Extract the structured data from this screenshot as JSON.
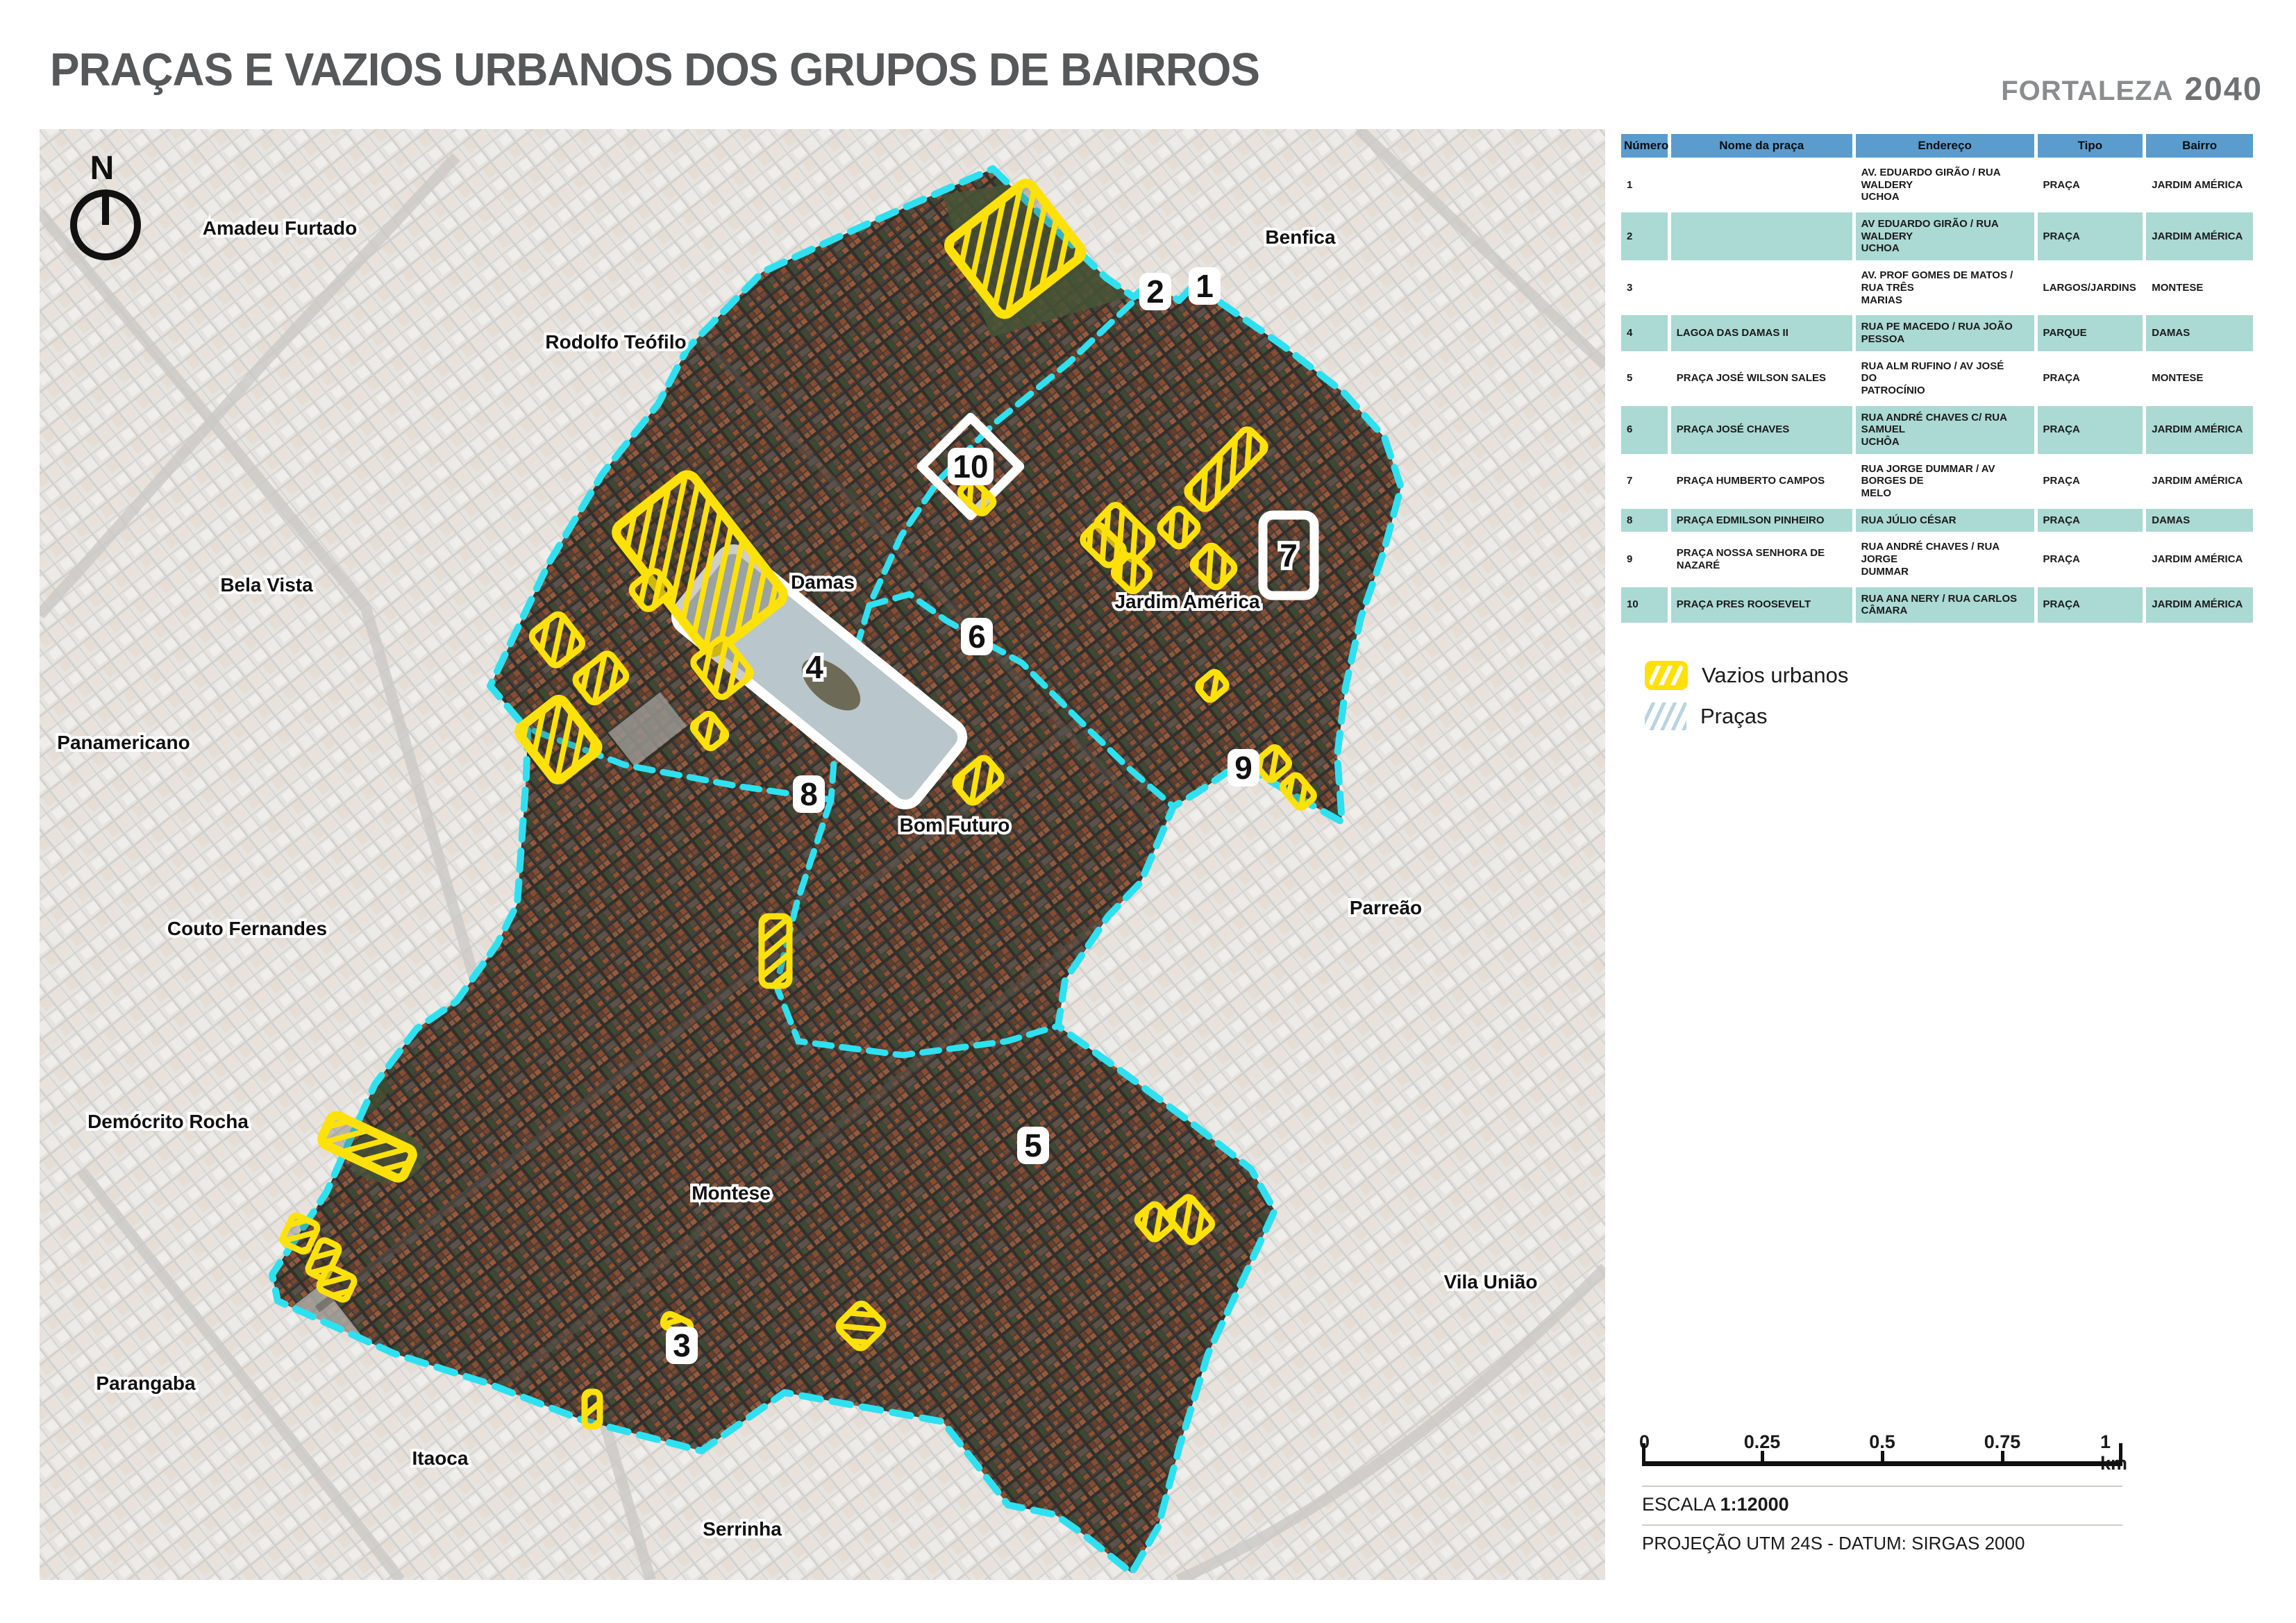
{
  "header": {
    "title": "PRAÇAS E VAZIOS URBANOS DOS GRUPOS DE BAIRROS",
    "brand_name": "FORTALEZA",
    "brand_year": "2040"
  },
  "map": {
    "compass": "N",
    "labels": [
      {
        "text": "Amadeu Furtado"
      },
      {
        "text": "Benfica"
      },
      {
        "text": "Rodolfo Teófilo"
      },
      {
        "text": "Bela Vista"
      },
      {
        "text": "Damas"
      },
      {
        "text": "Jardim América"
      },
      {
        "text": "Panamericano"
      },
      {
        "text": "Bom Futuro"
      },
      {
        "text": "Couto Fernandes"
      },
      {
        "text": "Parreão"
      },
      {
        "text": "Demócrito Rocha"
      },
      {
        "text": "Montese"
      },
      {
        "text": "Vila União"
      },
      {
        "text": "Parangaba"
      },
      {
        "text": "Itaoca"
      },
      {
        "text": "Serrinha"
      }
    ],
    "markers": [
      "1",
      "2",
      "3",
      "4",
      "5",
      "6",
      "7",
      "8",
      "9",
      "10"
    ]
  },
  "legend": {
    "items": [
      {
        "label": "Vazios urbanos",
        "swatch": "yellow-hatch"
      },
      {
        "label": "Praças",
        "swatch": "blue-hatch"
      }
    ]
  },
  "table": {
    "columns": [
      "Número",
      "Nome da praça",
      "Endereço",
      "Tipo",
      "Bairro"
    ],
    "rows": [
      {
        "numero": "1",
        "nome": "",
        "endereco": "AV. EDUARDO GIRÃO / RUA\nWALDERY\nUCHOA",
        "tipo": "PRAÇA",
        "bairro": "JARDIM AMÉRICA"
      },
      {
        "numero": "2",
        "nome": "",
        "endereco": "AV EDUARDO GIRÃO / RUA\nWALDERY\nUCHOA",
        "tipo": "PRAÇA",
        "bairro": "JARDIM AMÉRICA"
      },
      {
        "numero": "3",
        "nome": "",
        "endereco": "AV. PROF GOMES DE MATOS /\nRUA TRÊS\nMARIAS",
        "tipo": "LARGOS/JARDINS",
        "bairro": "MONTESE"
      },
      {
        "numero": "4",
        "nome": "LAGOA DAS DAMAS II",
        "endereco": "RUA PE MACEDO / RUA JOÃO\nPESSOA",
        "tipo": "PARQUE",
        "bairro": "DAMAS"
      },
      {
        "numero": "5",
        "nome": "PRAÇA JOSÉ WILSON SALES",
        "endereco": "RUA ALM RUFINO / AV JOSÉ\nDO\nPATROCÍNIO",
        "tipo": "PRAÇA",
        "bairro": "MONTESE"
      },
      {
        "numero": "6",
        "nome": "PRAÇA JOSÉ CHAVES",
        "endereco": "RUA ANDRÉ CHAVES C/ RUA\nSAMUEL\nUCHÔA",
        "tipo": "PRAÇA",
        "bairro": "JARDIM AMÉRICA"
      },
      {
        "numero": "7",
        "nome": "PRAÇA HUMBERTO CAMPOS",
        "endereco": "RUA JORGE DUMMAR / AV\nBORGES DE\nMELO",
        "tipo": "PRAÇA",
        "bairro": "JARDIM AMÉRICA"
      },
      {
        "numero": "8",
        "nome": "PRAÇA EDMILSON PINHEIRO",
        "endereco": "RUA JÚLIO CÉSAR",
        "tipo": "PRAÇA",
        "bairro": "DAMAS"
      },
      {
        "numero": "9",
        "nome": "PRAÇA NOSSA SENHORA DE\nNAZARÉ",
        "endereco": "RUA ANDRÉ CHAVES / RUA\nJORGE\nDUMMAR",
        "tipo": "PRAÇA",
        "bairro": "JARDIM AMÉRICA"
      },
      {
        "numero": "10",
        "nome": "PRAÇA PRES ROOSEVELT",
        "endereco": "RUA ANA NERY / RUA CARLOS\nCÂMARA",
        "tipo": "PRAÇA",
        "bairro": "JARDIM AMÉRICA"
      }
    ]
  },
  "scalebar": {
    "ticks": [
      "0",
      "0.25",
      "0.5",
      "0.75",
      "1 km"
    ]
  },
  "footer": {
    "escala_label": "ESCALA",
    "escala_value": "1:12000",
    "projecao": "PROJEÇÃO UTM 24S - DATUM: SIRGAS 2000"
  },
  "colors": {
    "accent_cyan_boundary": "#2fe1f0",
    "accent_yellow_vazio": "#ffe10a",
    "table_header_blue": "#5b9ccf",
    "table_cell_teal": "#abd9d3",
    "title_gray": "#57585a"
  }
}
